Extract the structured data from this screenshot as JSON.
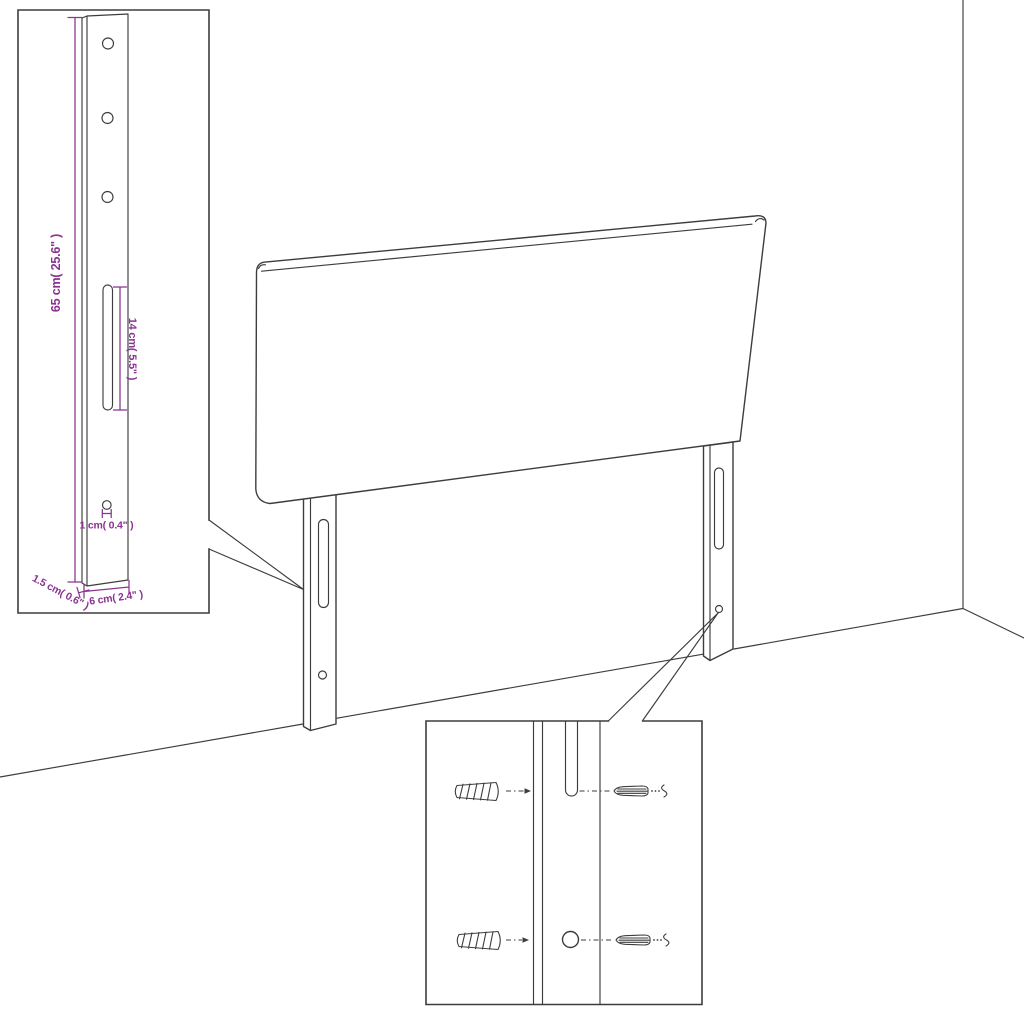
{
  "page": {
    "background": "#ffffff"
  },
  "colors": {
    "line": "#3d3d3f",
    "dimension": "#8a3390"
  },
  "scene": {
    "description": "Upholstered headboard with two slotted mounting legs shown against a wall corner, with two zoom insets",
    "labels": {
      "bracket_height": "65 cm( 25.6\" )",
      "slot_length": "14 cm( 5.5\" )",
      "hole_diameter": "1 cm( 0.4\" )",
      "bracket_thickness": "1.5 cm( 0.6\" )",
      "bracket_width": "6 cm( 2.4\" )"
    },
    "hardware_icons": [
      "wall-plug-icon",
      "screw-icon"
    ]
  }
}
